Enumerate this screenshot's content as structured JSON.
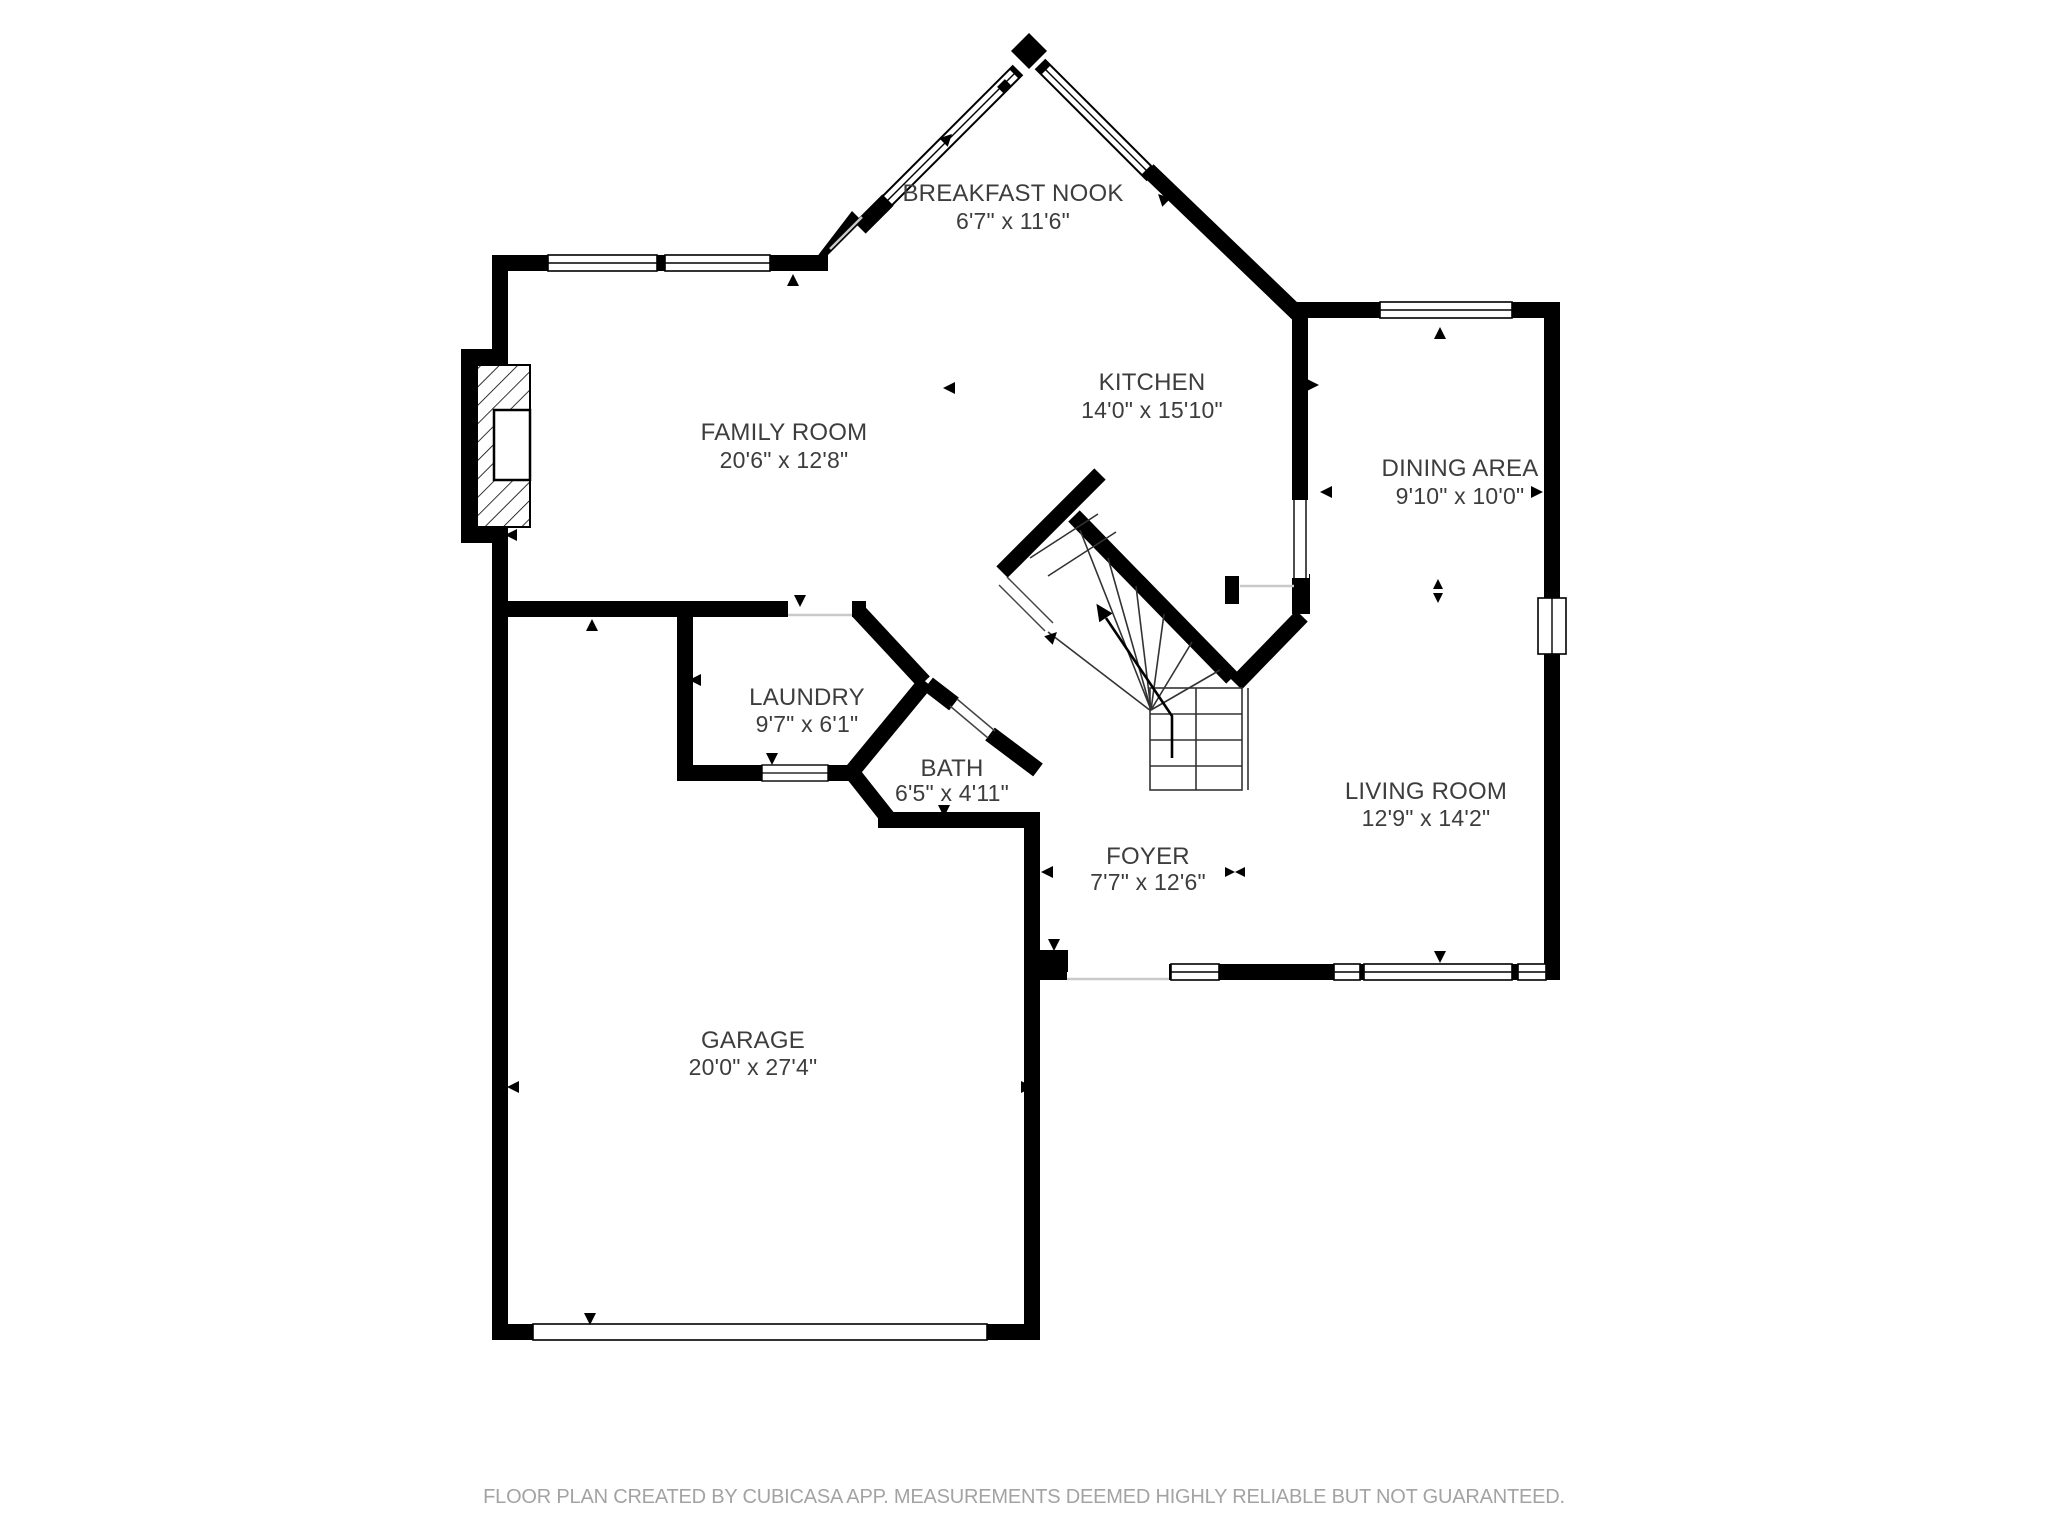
{
  "plan": {
    "background_color": "#ffffff",
    "wall_color": "#000000",
    "label_color": "#3d3d3d",
    "footer_color": "#a3a3a3"
  },
  "rooms": [
    {
      "id": "breakfast-nook",
      "name": "BREAKFAST NOOK",
      "dimensions": "6'7\" x 11'6\""
    },
    {
      "id": "kitchen",
      "name": "KITCHEN",
      "dimensions": "14'0\" x 15'10\""
    },
    {
      "id": "family-room",
      "name": "FAMILY ROOM",
      "dimensions": "20'6\" x 12'8\""
    },
    {
      "id": "dining-area",
      "name": "DINING AREA",
      "dimensions": "9'10\" x 10'0\""
    },
    {
      "id": "laundry",
      "name": "LAUNDRY",
      "dimensions": "9'7\" x 6'1\""
    },
    {
      "id": "bath",
      "name": "BATH",
      "dimensions": "6'5\" x 4'11\""
    },
    {
      "id": "living-room",
      "name": "LIVING ROOM",
      "dimensions": "12'9\" x 14'2\""
    },
    {
      "id": "foyer",
      "name": "FOYER",
      "dimensions": "7'7\" x 12'6\""
    },
    {
      "id": "garage",
      "name": "GARAGE",
      "dimensions": "20'0\" x 27'4\""
    }
  ],
  "footer": {
    "text": "FLOOR PLAN CREATED BY CUBICASA APP. MEASUREMENTS DEEMED HIGHLY RELIABLE BUT NOT GUARANTEED."
  }
}
